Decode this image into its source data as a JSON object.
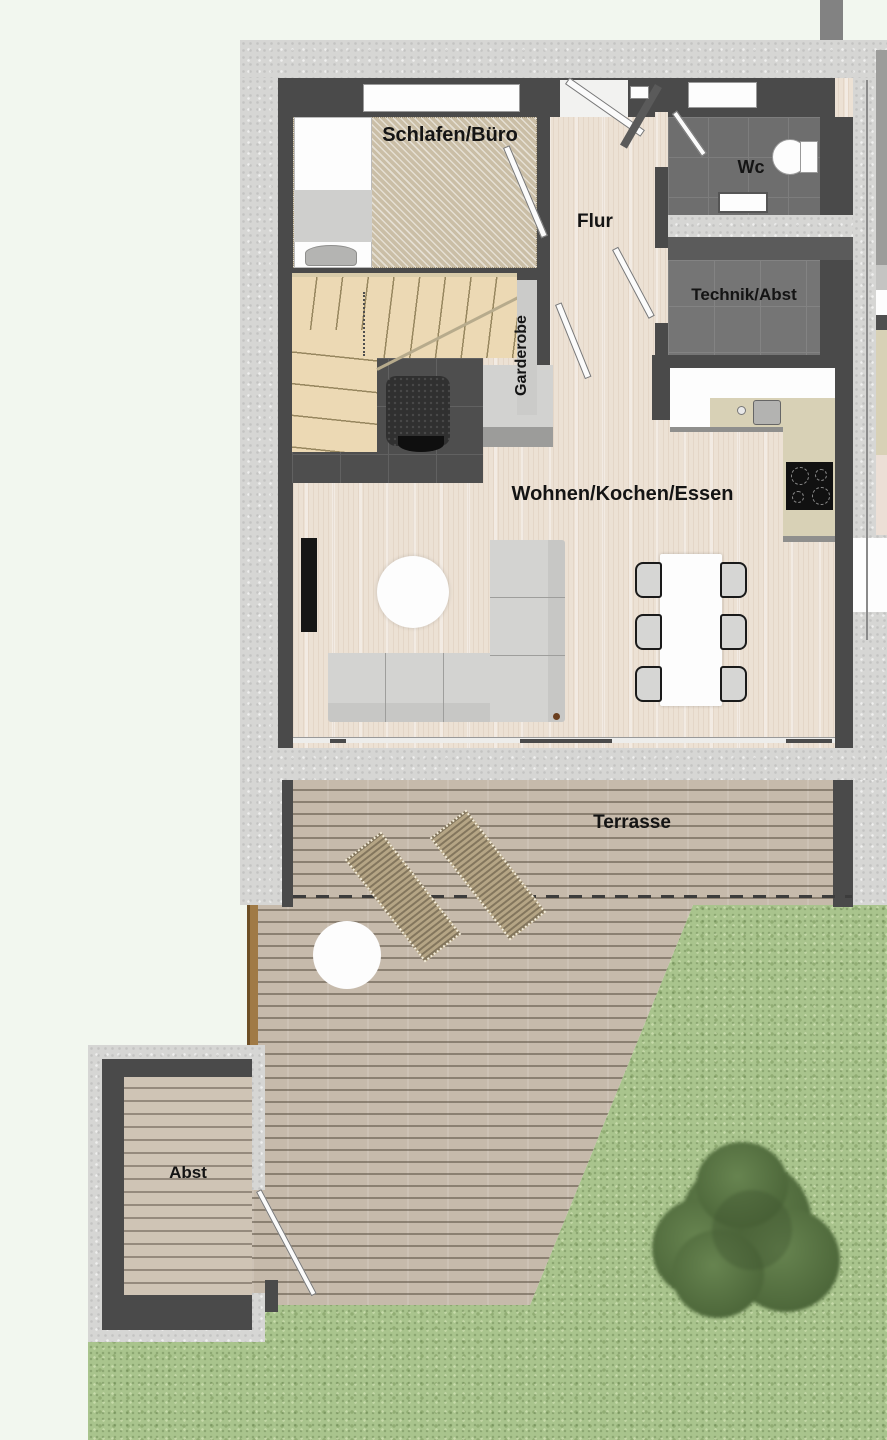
{
  "plan": {
    "type": "floorplan-top-view",
    "rooms": [
      {
        "id": "schlafen",
        "label": "Schlafen/Büro"
      },
      {
        "id": "flur",
        "label": "Flur"
      },
      {
        "id": "wc",
        "label": "Wc"
      },
      {
        "id": "technik",
        "label": "Technik/Abst"
      },
      {
        "id": "garderobe",
        "label": "Garderobe"
      },
      {
        "id": "wohnen",
        "label": "Wohnen/Kochen/Essen"
      },
      {
        "id": "terrasse",
        "label": "Terrasse"
      },
      {
        "id": "abst",
        "label": "Abst"
      }
    ],
    "furniture": [
      "bed",
      "winder-stairs",
      "armchair",
      "wardrobe-nook",
      "toilet",
      "sink",
      "kitchen-counter",
      "kitchen-sink",
      "cooktop",
      "corner-sofa",
      "round-rug",
      "tv",
      "dining-table",
      "six-chairs",
      "two-sun-loungers",
      "round-side-table",
      "garden-shed",
      "tree"
    ]
  },
  "colors": {
    "bg": "#f2f7ef",
    "concrete": "#d6d6d4",
    "wall_dark": "#4a4a4a",
    "wood_floor": "#ece1d4",
    "carpet": "#cabea6",
    "stairs": "#ecd9b4",
    "kitchen_counter": "#d8d1b6",
    "deck": "#c6baab",
    "grass": "#a9c48d",
    "lounger": "#b5a585",
    "tree": "#4c6639"
  }
}
